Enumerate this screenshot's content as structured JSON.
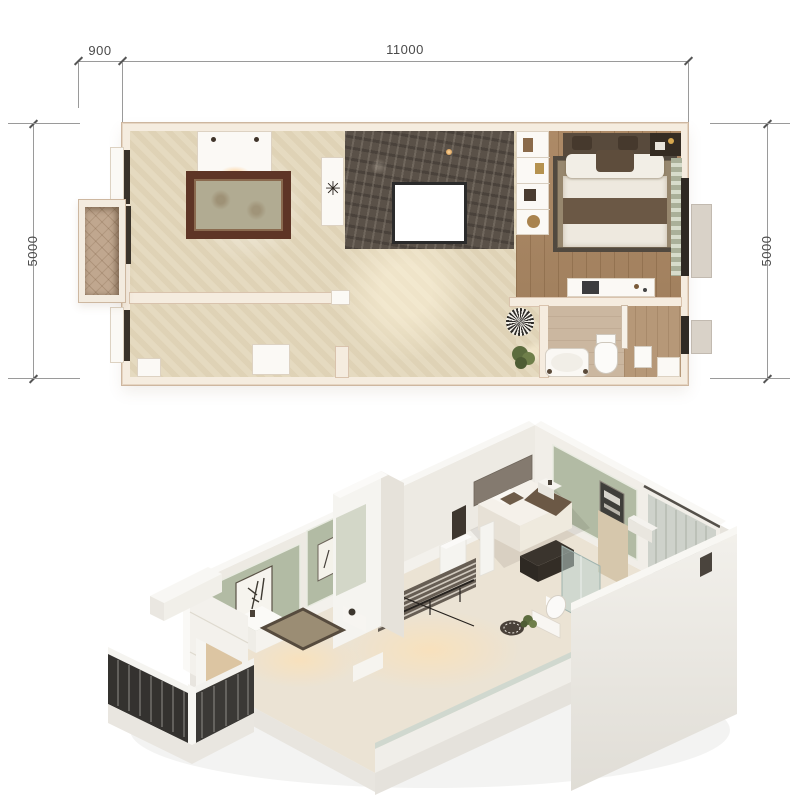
{
  "figure": {
    "type": "apartment floor plan with 3D cutaway dollhouse view",
    "background": "#ffffff"
  },
  "floor_plan": {
    "dimensions": {
      "top_offset_label": "900",
      "top_width_label": "11000",
      "left_height_label": "5000",
      "right_height_label": "5000",
      "unit": "mm"
    },
    "rooms": [
      {
        "name": "living-room"
      },
      {
        "name": "hall"
      },
      {
        "name": "stair-void"
      },
      {
        "name": "bedroom"
      },
      {
        "name": "bathroom"
      },
      {
        "name": "balcony"
      }
    ],
    "furniture": [
      "sofa",
      "ornate-area-rug",
      "side-table-with-starburst",
      "shelf-unit",
      "double-bed",
      "nightstands",
      "curtain",
      "desk-console",
      "toilet",
      "bathtub",
      "towel-stand",
      "round-dotted-rug",
      "potted-plant",
      "cabinet"
    ]
  },
  "iso_view": {
    "rooms": [
      {
        "name": "living-room"
      },
      {
        "name": "staircase"
      },
      {
        "name": "bedroom"
      },
      {
        "name": "bathroom"
      },
      {
        "name": "balcony"
      }
    ],
    "features": [
      "sage-green-wall-panels",
      "calligraphy-art",
      "curtains",
      "glass-balustrade",
      "dark-metal-balcony-railing",
      "glass-shower",
      "dark-media-unit"
    ]
  },
  "colors": {
    "dimText": "#4a4a4a",
    "dimLine": "#9a9a9a",
    "wall": "#f5ecdf",
    "wallEdge": "#cdb69f",
    "floorBeige": "#e3d7bb",
    "wood": "#ad8a67",
    "marble": "#5a5148",
    "balconyTile": "#c0a78f",
    "rugBorder": "#5e3526",
    "rugField": "#b1ab92",
    "bedRug": "#97876e",
    "bedWhite": "#eee9df",
    "headboard": "#584a3c",
    "throw": "#6b5845",
    "tile1": "#cbb7a0",
    "tile2": "#b69878",
    "sage": "#b2bba4",
    "isoWall": "#efece6",
    "isoWallShade": "#e4e0d8",
    "isoFloor": "#ebe3d4",
    "stairDark": "#675e54",
    "railing": "#34322f",
    "glass": "rgba(186,208,202,0.55)",
    "curtain": "#ced2cb",
    "plant": "#5c6c3e",
    "fixture": "#fbfaf8"
  }
}
